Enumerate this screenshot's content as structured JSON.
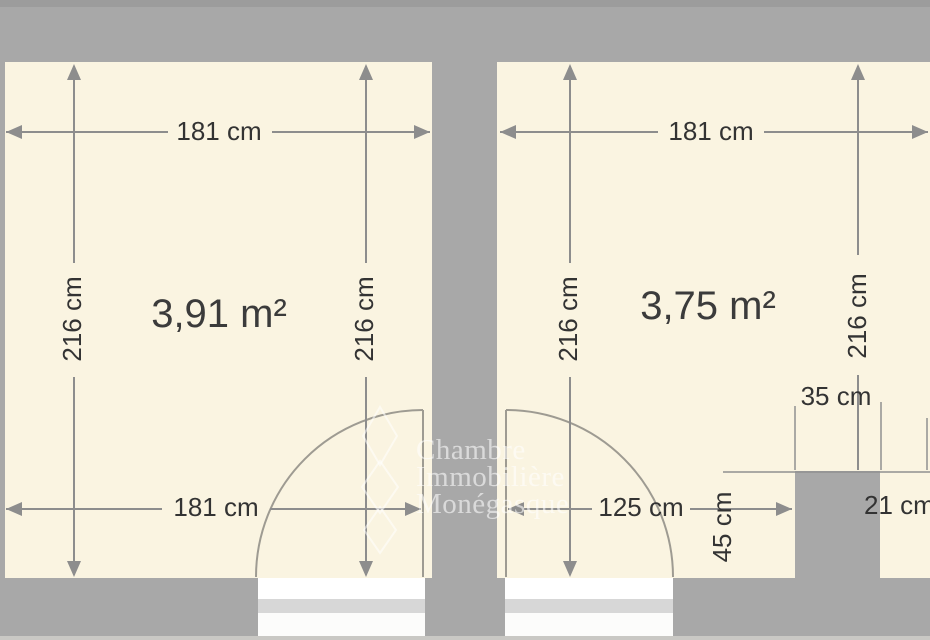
{
  "plan": {
    "type": "floor-plan",
    "rooms": [
      {
        "name": "left-room",
        "area": "3,91 m²",
        "top_width": "181 cm",
        "bottom_width": "181 cm",
        "left_height": "216 cm",
        "right_height": "216 cm"
      },
      {
        "name": "right-room",
        "area": "3,75 m²",
        "top_width": "181 cm",
        "left_height": "216 cm",
        "right_height": "216 cm",
        "door_clearance": "125 cm",
        "pillar_width": "35 cm",
        "pillar_depth": "45 cm",
        "right_gap": "21 cm"
      }
    ],
    "watermark": {
      "line1": "Chambre",
      "line2": "Immobilière",
      "line3": "Monégasque"
    },
    "colors": {
      "floor": "#faf4e1",
      "wall": "#a8a8a8",
      "dimension_line": "#8d8d8d",
      "dimension_text": "#333333",
      "door_line": "#9e9b92",
      "threshold_stripe": "#d7d7d7",
      "watermark": "#ffffff"
    }
  }
}
